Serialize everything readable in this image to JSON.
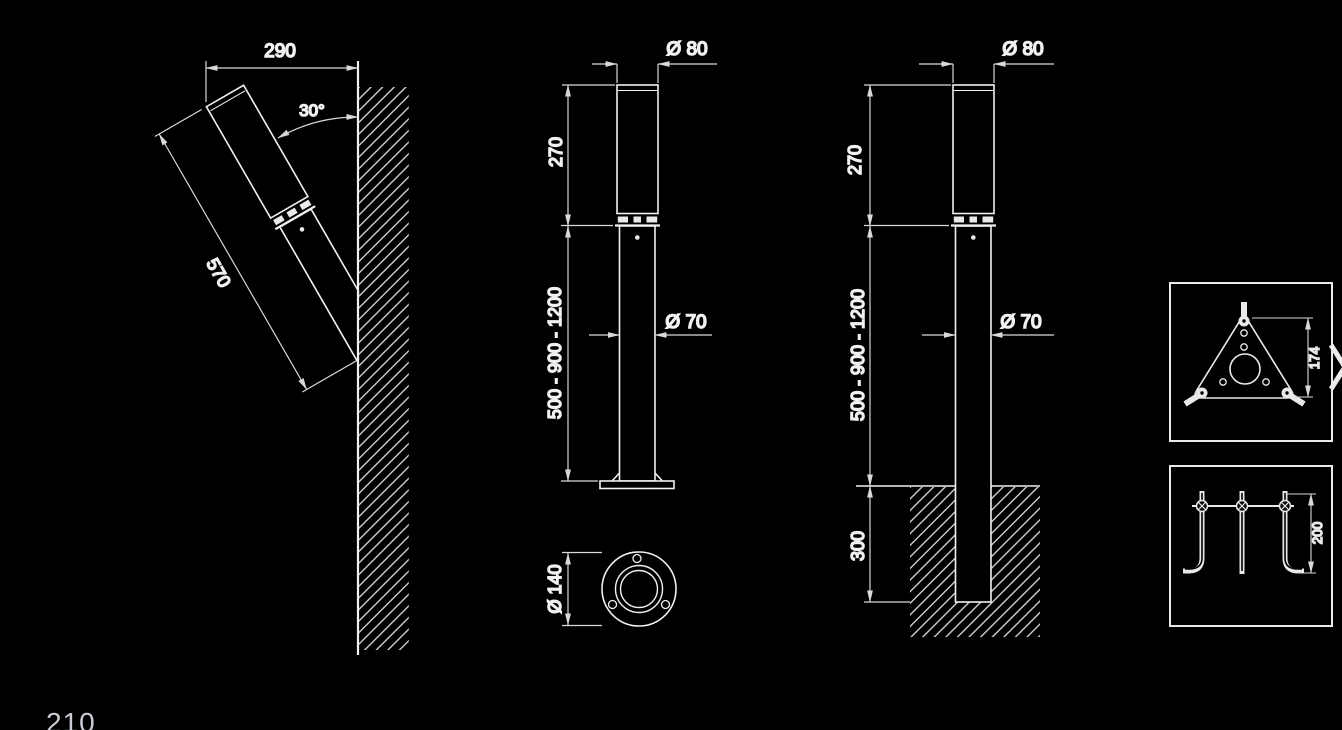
{
  "page": {
    "background": "#000000",
    "page_number": "210"
  },
  "carousel": {
    "next_icon": "chevron-right"
  },
  "drawing": {
    "geometry_color": "#f1f1f1",
    "dimension_color": "#d9d9d9",
    "text_color": "#f4f4f4",
    "views": {
      "wall_mounted_luminaire": {
        "width": "290",
        "tilt_angle": "30°",
        "body_length": "570"
      },
      "bollard_surface_mounted": {
        "head_diameter": "Ø 80",
        "head_height": "270",
        "pole_height_options": "500 - 900 - 1200",
        "pole_diameter": "Ø 70",
        "base_plate_diameter": "Ø 140"
      },
      "bollard_ground_buried": {
        "head_diameter": "Ø 80",
        "head_height": "270",
        "pole_height_options": "500 - 900 - 1200",
        "pole_diameter": "Ø 70",
        "burial_depth": "300"
      },
      "detail_mounting_plate": {
        "plate_height": "174"
      },
      "detail_anchor_bolts": {
        "bolt_length": "200"
      }
    }
  }
}
